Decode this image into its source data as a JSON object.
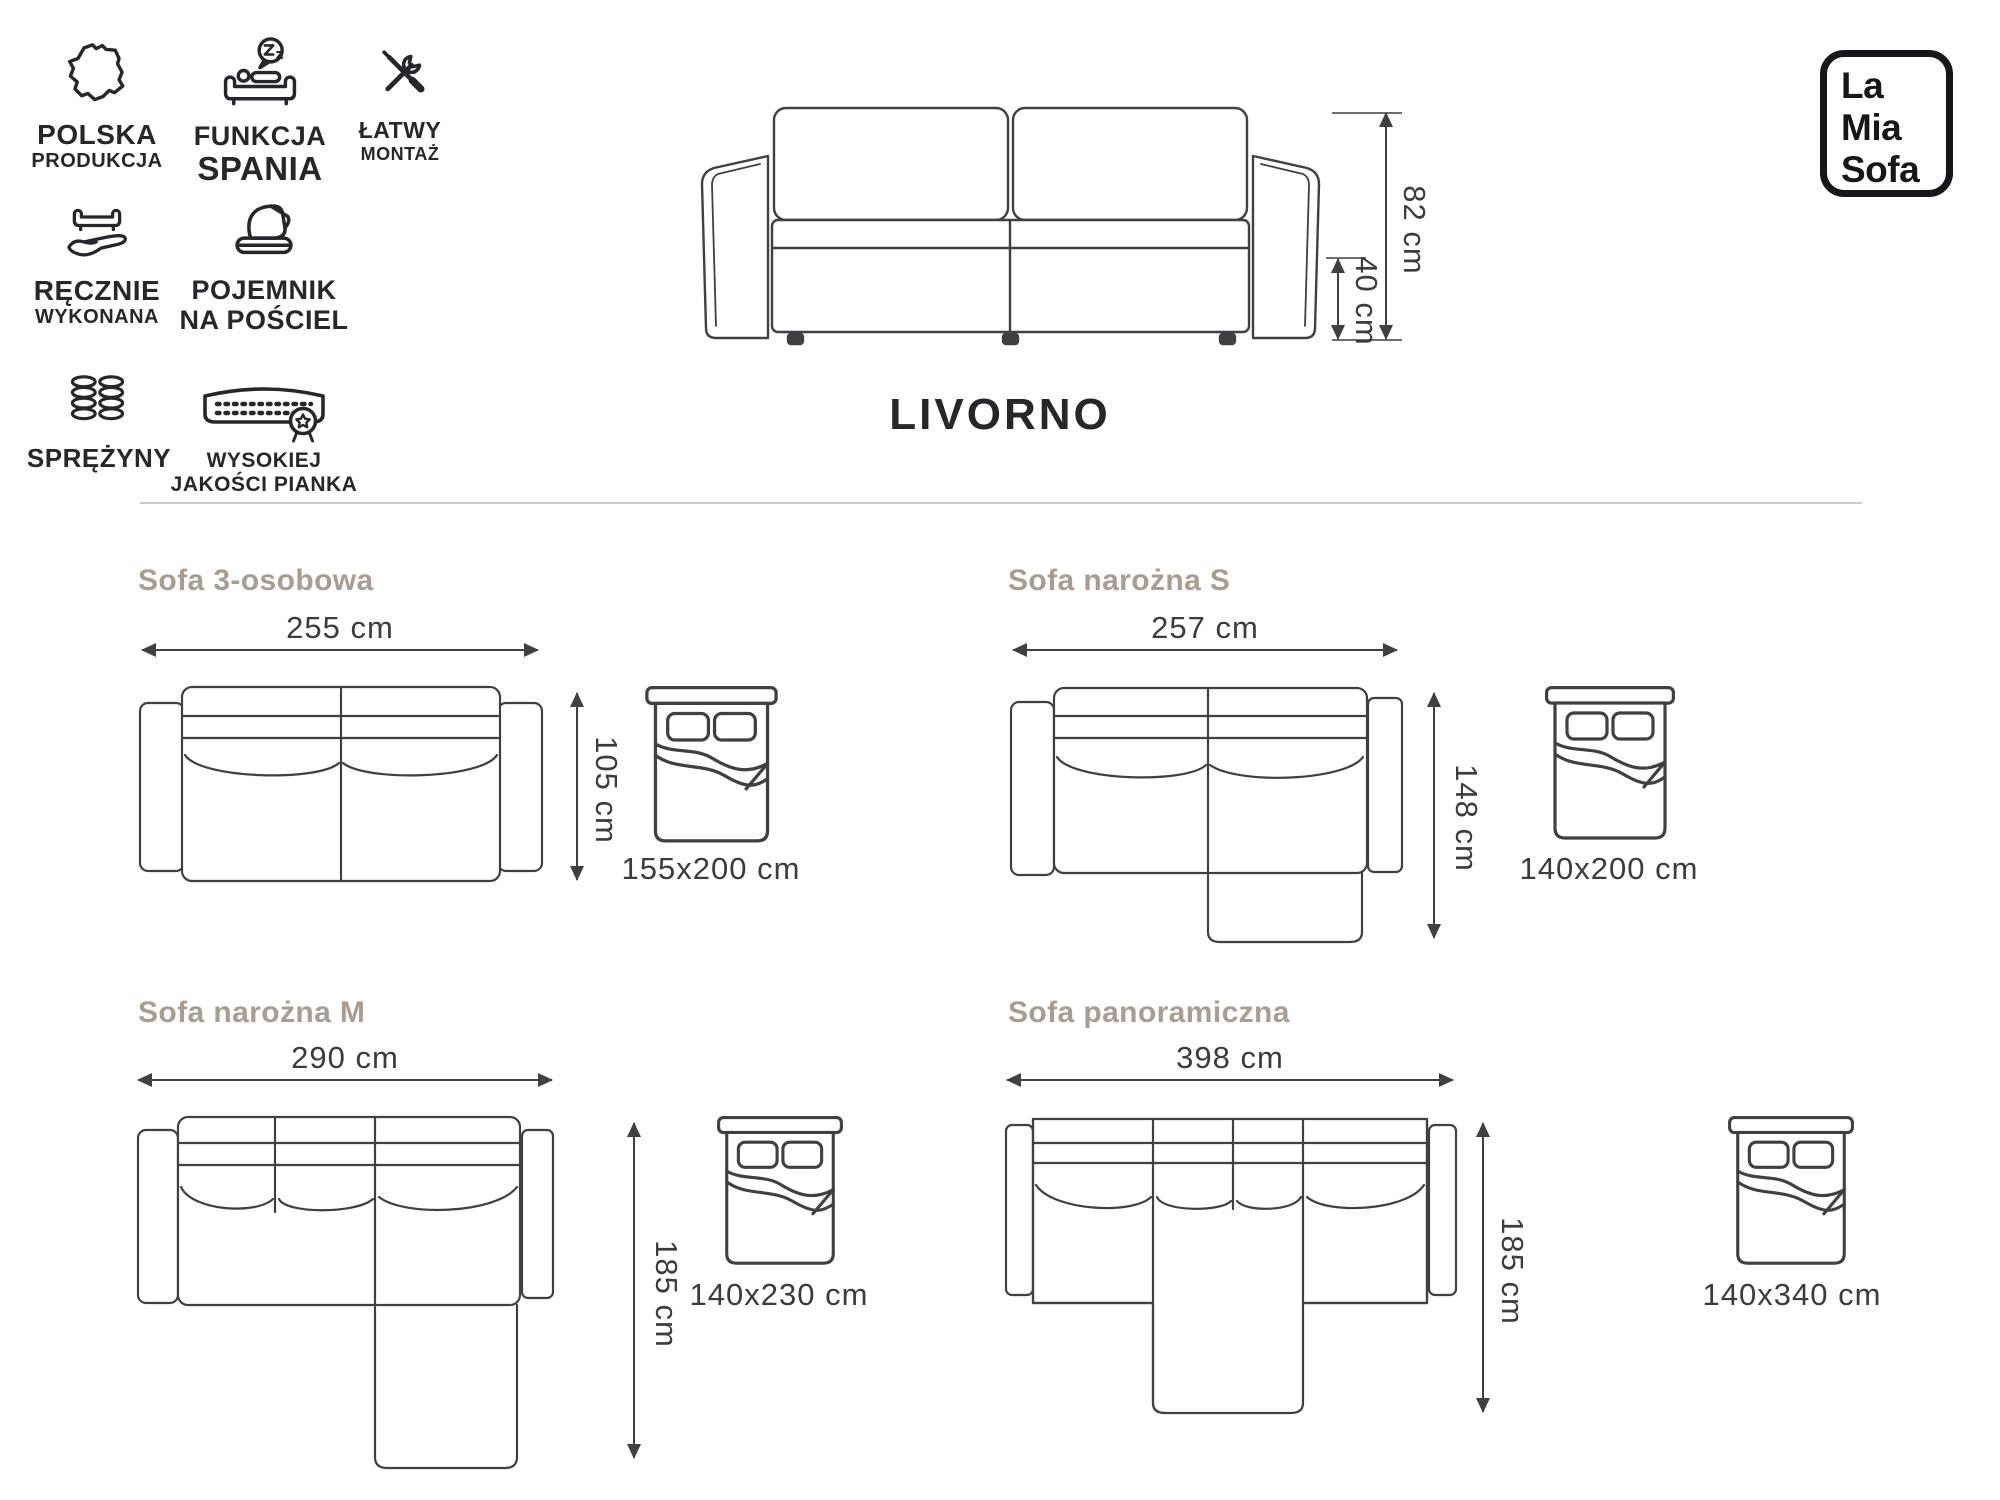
{
  "product": {
    "name": "LIVORNO",
    "height": "82 cm",
    "seat_height": "40 cm"
  },
  "brand_logo": {
    "line1": "La",
    "line2": "Mia",
    "line3": "Sofa"
  },
  "features": [
    {
      "icon": "poland-map-icon",
      "line1": "POLSKA",
      "line2": "PRODUKCJA"
    },
    {
      "icon": "sleep-function-icon",
      "line1": "FUNKCJA",
      "line2": "SPANIA"
    },
    {
      "icon": "tools-icon",
      "line1": "ŁATWY",
      "line2": "MONTAŻ"
    },
    {
      "icon": "hand-sofa-icon",
      "line1": "RĘCZNIE",
      "line2": "WYKONANA"
    },
    {
      "icon": "bedding-container-icon",
      "line1": "POJEMNIK",
      "line2": "NA POŚCIEL"
    },
    {
      "icon": "springs-icon",
      "line1": "SPRĘŻYNY",
      "line2": ""
    },
    {
      "icon": "foam-quality-icon",
      "line1": "WYSOKIEJ",
      "line2": "JAKOŚCI PIANKA"
    }
  ],
  "variants": [
    {
      "title": "Sofa 3-osobowa",
      "width": "255 cm",
      "depth": "105 cm",
      "bed_size": "155x200 cm"
    },
    {
      "title": "Sofa narożna S",
      "width": "257 cm",
      "depth": "148 cm",
      "bed_size": "140x200 cm"
    },
    {
      "title": "Sofa narożna M",
      "width": "290 cm",
      "depth": "185 cm",
      "bed_size": "140x230 cm"
    },
    {
      "title": "Sofa panoramiczna",
      "width": "398 cm",
      "depth": "185 cm",
      "bed_size": "140x340 cm"
    }
  ],
  "colors": {
    "line": "#3f3f44",
    "text": "#3b3b40",
    "heading": "#26262c",
    "variant_title": "#a89d8e",
    "divider": "#c9c9c9",
    "logo": "#16161c"
  }
}
